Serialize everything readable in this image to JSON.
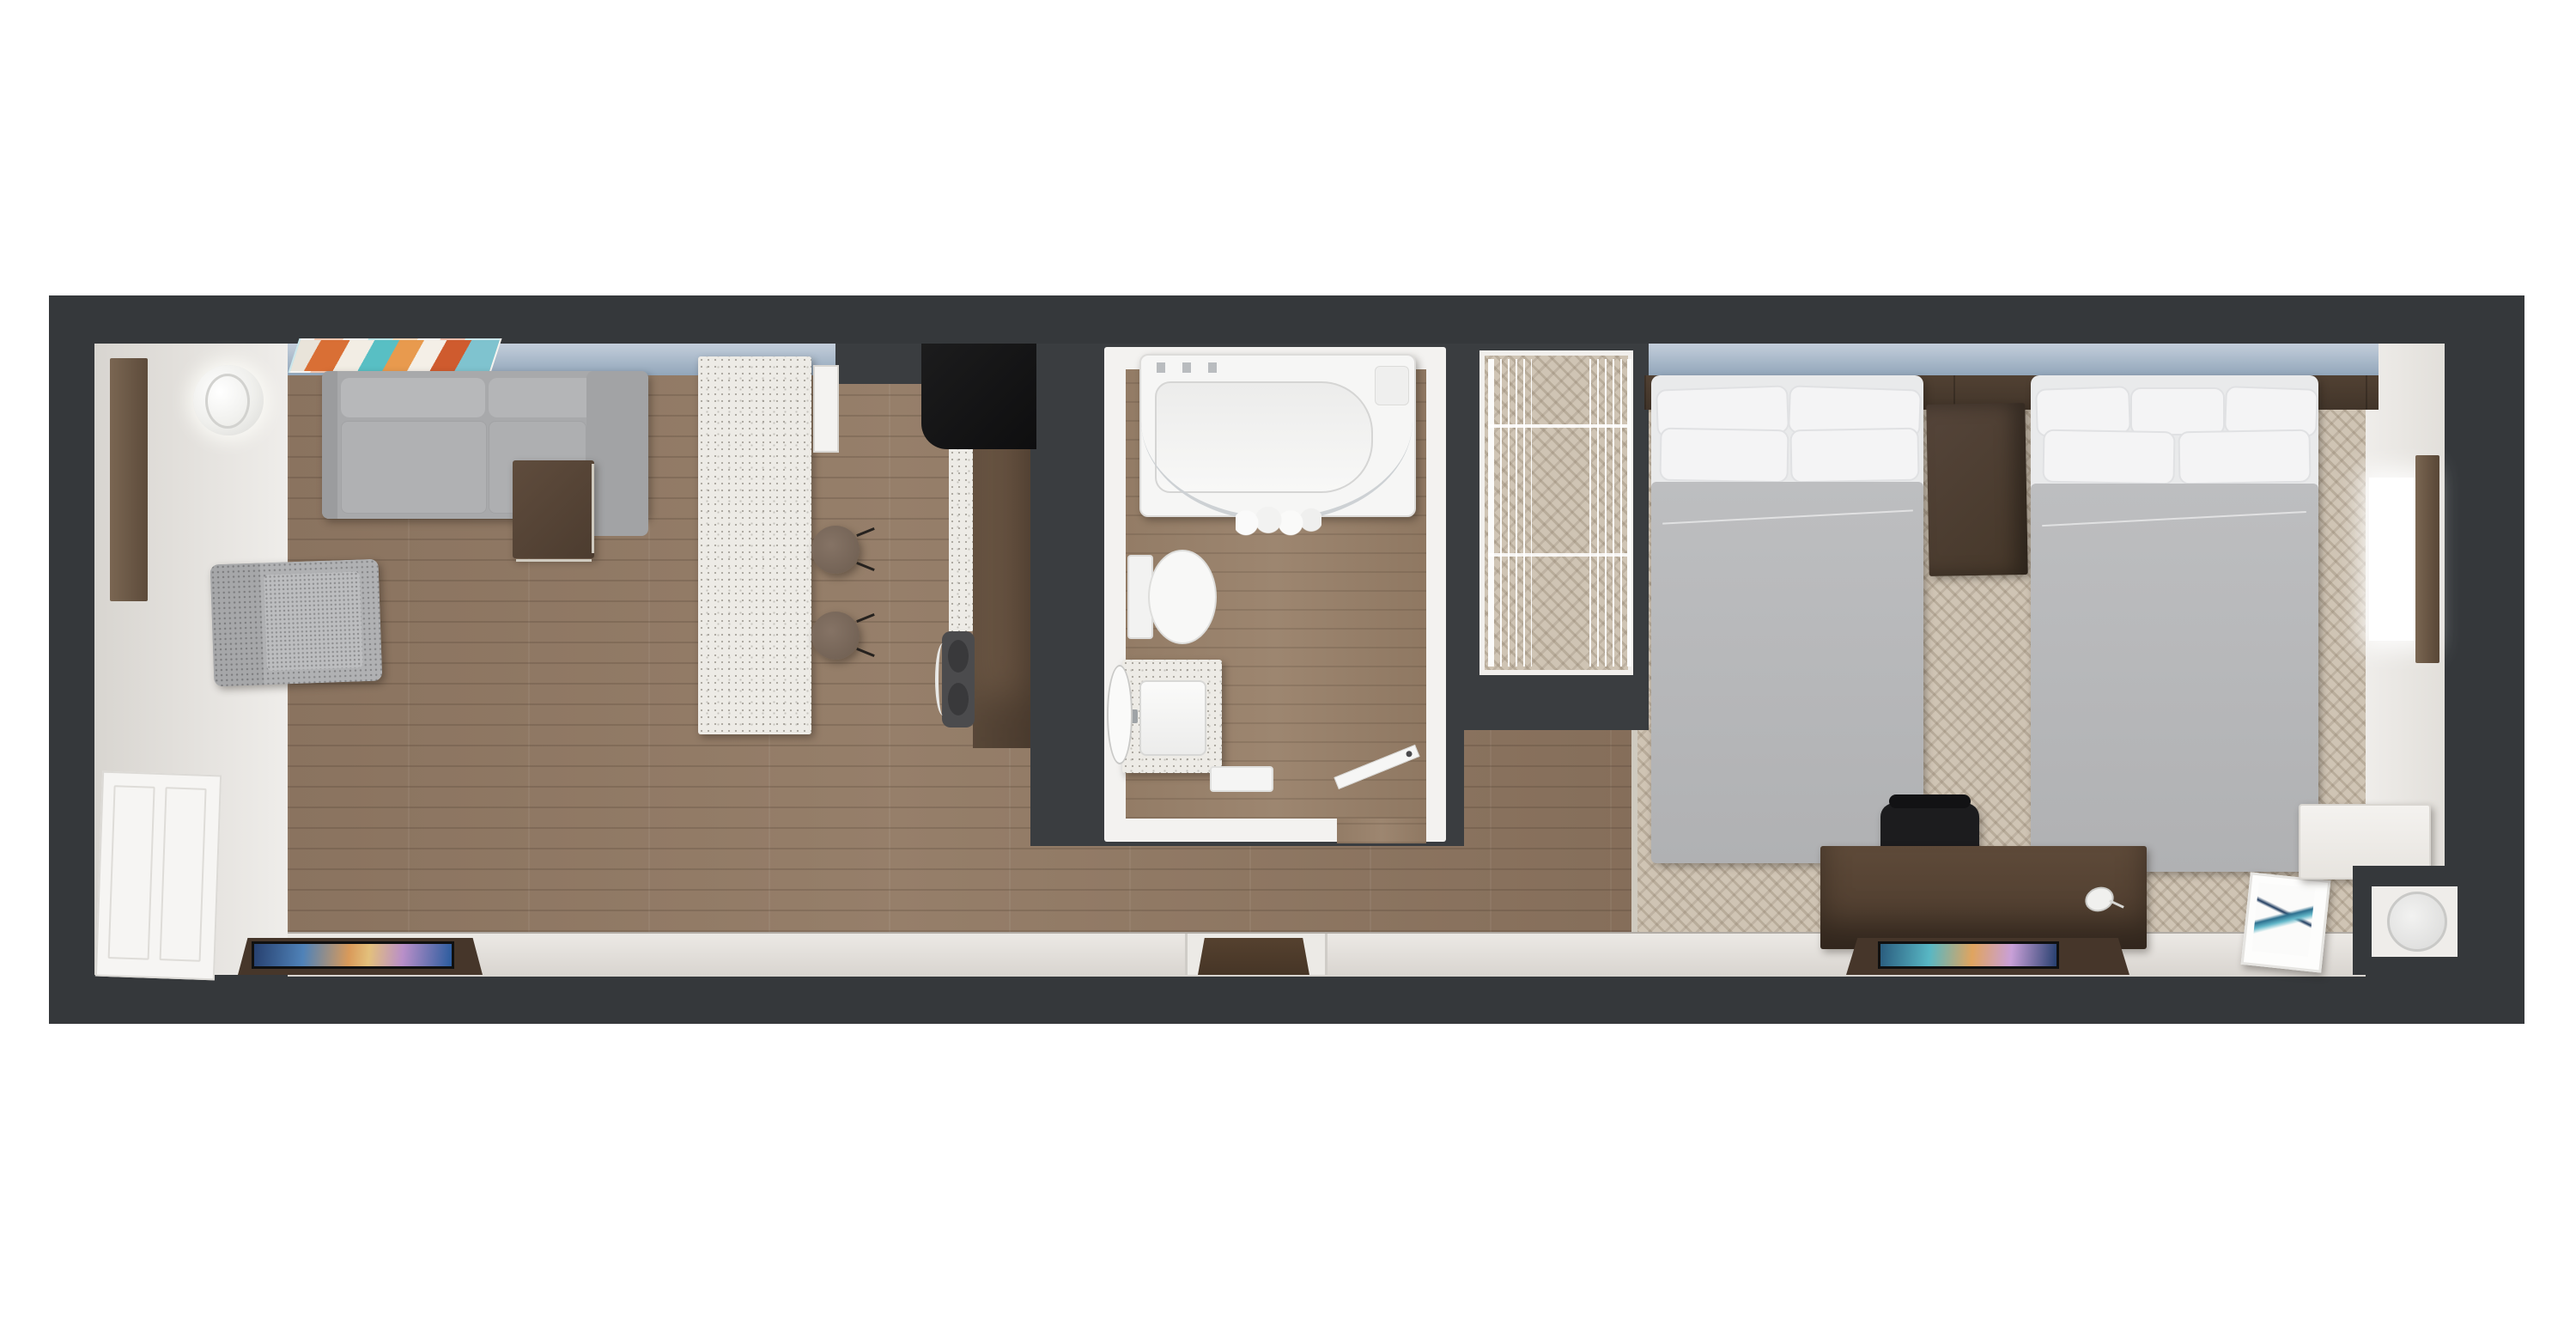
{
  "scene": {
    "type": "3d-floor-plan-render",
    "description": "Top-down 3D render of a studio hotel suite: living room and kitchen on the left, central bathroom and closet block, double-queen bedroom on the right",
    "rooms": [
      {
        "name": "living-room",
        "items": [
          "sectional-sofa",
          "accent-chair",
          "floor-lamp",
          "wall-art",
          "side-table",
          "tv",
          "tv-credenza",
          "full-length-mirror",
          "closet-doors"
        ]
      },
      {
        "name": "kitchen",
        "items": [
          "island",
          "bar-stool-1",
          "bar-stool-2",
          "wall-cabinet",
          "black-counter",
          "counter-run",
          "sink"
        ]
      },
      {
        "name": "bathroom",
        "items": [
          "bathtub",
          "shower-curtain-rod",
          "shower-curtain",
          "toilet",
          "vanity-sink",
          "leaning-mirror",
          "towel",
          "door"
        ]
      },
      {
        "name": "closet",
        "items": [
          "wire-shelving-left",
          "wire-shelving-right"
        ]
      },
      {
        "name": "bedroom",
        "items": [
          "bed-1",
          "bed-2",
          "nightstand",
          "headboard-ledge",
          "pendant-light-1",
          "pendant-light-2",
          "desk",
          "desk-chair",
          "tv",
          "tv-credenza",
          "framed-art",
          "luggage-bench",
          "mini-fridge",
          "window",
          "full-length-mirror"
        ]
      }
    ],
    "labels": {
      "plan": "Suite floor plan (top-down 3D render)",
      "living_room": "Living room",
      "kitchen": "Kitchen",
      "bathroom": "Bathroom",
      "closet": "Closet",
      "bedroom": "Bedroom with two queen beds",
      "sofa": "Gray sectional sofa",
      "accent_chair": "Textured accent chair",
      "floor_lamp": "Round floor lamp",
      "wall_art": "Abstract wall art",
      "side_table": "Wood side table",
      "tv_living": "Living room TV",
      "credenza_living": "Living room TV credenza",
      "mirror_left": "Full-length mirror (left wall)",
      "closet_doors": "White paneled closet doors",
      "island": "Kitchen island with quartz top",
      "stool": "Bar stool",
      "wall_cabinet": "Wall cabinet",
      "black_counter": "Black counter / cooktop",
      "counter_run": "Kitchen counter run",
      "kitchen_sink": "Kitchen sink",
      "bathtub": "Bathtub",
      "curtain_rod": "Curved shower rod",
      "curtain": "Shower curtain",
      "toilet": "Toilet",
      "vanity": "Vanity with sink",
      "bath_mirror": "Leaning vanity mirror",
      "towel": "Towel",
      "bath_door": "Bathroom door",
      "wire_shelving": "Closet wire shelving",
      "bed1": "Queen bed 1",
      "bed2": "Queen bed 2",
      "nightstand": "Shared nightstand",
      "headboard": "Headboard ledge",
      "pendant": "Pendant light",
      "desk": "Work desk",
      "desk_chair": "Desk chair",
      "tv_bedroom": "Bedroom TV",
      "credenza_bedroom": "Bedroom TV credenza",
      "framed_art": "Framed art leaning on bench",
      "bench": "Luggage bench",
      "fridge": "Mini fridge in niche",
      "window_right": "Window (right wall)",
      "mirror_right": "Full-length mirror (right wall)",
      "window_wall": "Window wall (glazing)",
      "entry_door": "Entry door",
      "door_mat": "Entry door mat",
      "wood_floor": "Wood plank flooring",
      "carpet_floor": "Patterned carpet flooring"
    },
    "palette": {
      "wall_frame": "#35383b",
      "wall_face_light": "#ece9e5",
      "window_glass_top": "#c3cedb",
      "window_glass_bottom": "#92a6ba",
      "wood_floor": "#8e7763",
      "carpet": "#cfc4b4",
      "counter_speckle": "#edebe6",
      "cabinet_wood": "#6e5946",
      "dark_wood": "#4a3a2c",
      "sofa_gray": "#aaabad",
      "bed_duvet": "#b7b8ba",
      "pillow_white": "#f4f4f5",
      "fixture_white": "#f7f7f6",
      "black_counter": "#151515",
      "tv_screen_colors": [
        "#27406f",
        "#4f82b8",
        "#d99a5a",
        "#b98fc9",
        "#2a5c9e"
      ],
      "art_colors": [
        "#d96f35",
        "#58bfc4",
        "#f2ede4",
        "#cf5b2e",
        "#7fc3cf"
      ]
    }
  }
}
